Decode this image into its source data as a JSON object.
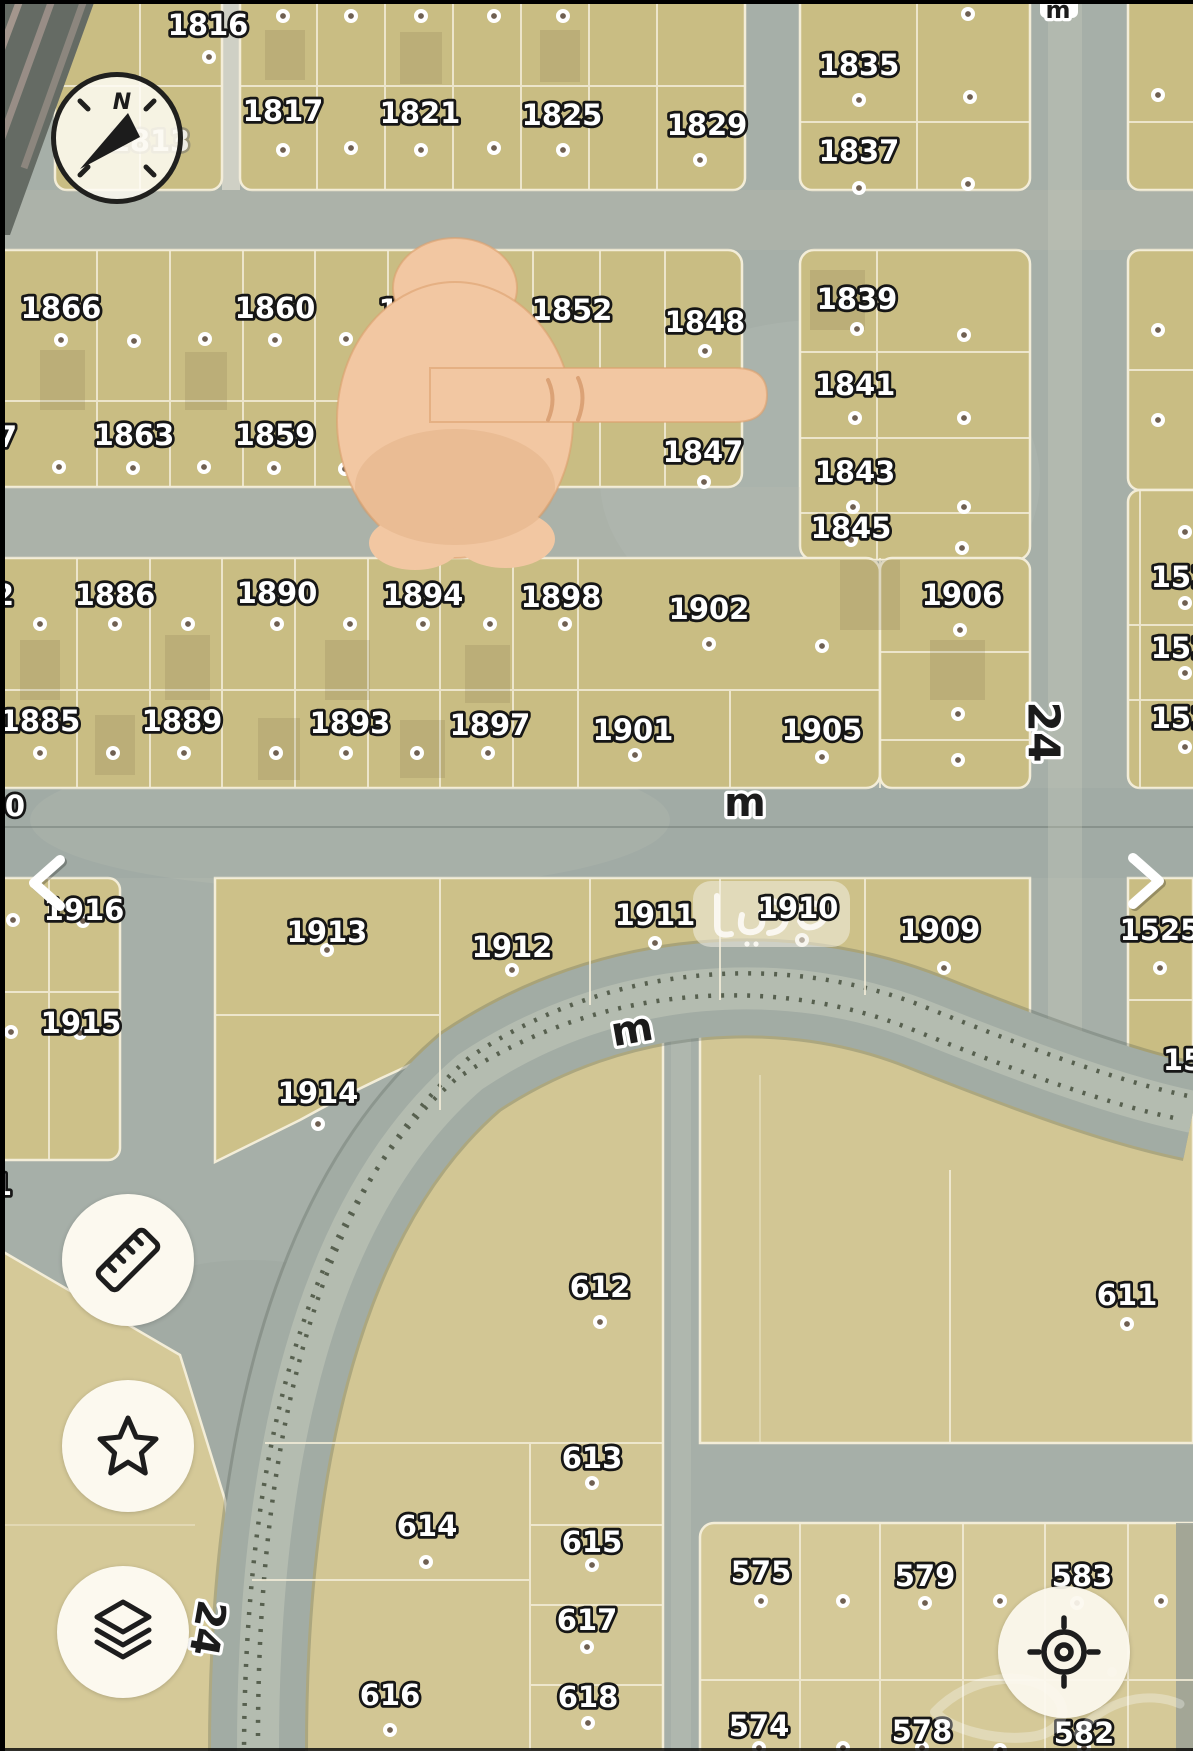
{
  "app": {
    "type": "satellite-parcel-map"
  },
  "colors": {
    "parcel_fill": "#c9bd83",
    "parcel_fill_light": "#d5c998",
    "road": "#a6afa8",
    "block_line": "#f3edd8",
    "label_fill": "#ffffff",
    "label_stroke": "#161616",
    "road_label_fill": "#1b1b1b",
    "dot_inner": "#6f6052",
    "hand_skin": "#f2c7a2",
    "button_bg": "#fcf9ef",
    "icon_stroke": "#1d1d1d"
  },
  "map": {
    "parcel_labels": [
      {
        "t": "1816",
        "x": 208,
        "y": 25
      },
      {
        "t": "1817",
        "x": 283,
        "y": 111
      },
      {
        "t": "1821",
        "x": 420,
        "y": 113
      },
      {
        "t": "1825",
        "x": 562,
        "y": 115
      },
      {
        "t": "1829",
        "x": 707,
        "y": 125
      },
      {
        "t": "1835",
        "x": 859,
        "y": 65
      },
      {
        "t": "1837",
        "x": 859,
        "y": 151
      },
      {
        "t": "1866",
        "x": 61,
        "y": 308
      },
      {
        "t": "1860",
        "x": 275,
        "y": 308
      },
      {
        "t": "1856",
        "x": 419,
        "y": 310
      },
      {
        "t": "1852",
        "x": 572,
        "y": 310
      },
      {
        "t": "1848",
        "x": 705,
        "y": 322
      },
      {
        "t": "7",
        "x": 7,
        "y": 437
      },
      {
        "t": "1863",
        "x": 134,
        "y": 435
      },
      {
        "t": "1859",
        "x": 275,
        "y": 435
      },
      {
        "t": "1847",
        "x": 703,
        "y": 452
      },
      {
        "t": "1839",
        "x": 857,
        "y": 299
      },
      {
        "t": "1841",
        "x": 855,
        "y": 385
      },
      {
        "t": "1843",
        "x": 855,
        "y": 472
      },
      {
        "t": "1845",
        "x": 851,
        "y": 528
      },
      {
        "t": "2",
        "x": 4,
        "y": 595
      },
      {
        "t": "1886",
        "x": 115,
        "y": 595
      },
      {
        "t": "1890",
        "x": 277,
        "y": 593
      },
      {
        "t": "1894",
        "x": 423,
        "y": 595
      },
      {
        "t": "1898",
        "x": 561,
        "y": 597
      },
      {
        "t": "1902",
        "x": 709,
        "y": 609
      },
      {
        "t": "1906",
        "x": 962,
        "y": 595
      },
      {
        "t": "1885",
        "x": 40,
        "y": 721
      },
      {
        "t": "1889",
        "x": 182,
        "y": 721
      },
      {
        "t": "1893",
        "x": 350,
        "y": 723
      },
      {
        "t": "1897",
        "x": 490,
        "y": 725
      },
      {
        "t": "1901",
        "x": 633,
        "y": 730
      },
      {
        "t": "1905",
        "x": 822,
        "y": 730
      },
      {
        "t": "0",
        "x": 15,
        "y": 806
      },
      {
        "t": "152",
        "x": 1181,
        "y": 577
      },
      {
        "t": "152",
        "x": 1181,
        "y": 648
      },
      {
        "t": "152",
        "x": 1181,
        "y": 718
      },
      {
        "t": "1916",
        "x": 84,
        "y": 910
      },
      {
        "t": "1915",
        "x": 81,
        "y": 1023
      },
      {
        "t": "1913",
        "x": 327,
        "y": 932
      },
      {
        "t": "1912",
        "x": 512,
        "y": 947
      },
      {
        "t": "1911",
        "x": 655,
        "y": 915
      },
      {
        "t": "1910",
        "x": 798,
        "y": 908
      },
      {
        "t": "1909",
        "x": 940,
        "y": 930
      },
      {
        "t": "1525",
        "x": 1160,
        "y": 930
      },
      {
        "t": "15",
        "x": 1183,
        "y": 1060
      },
      {
        "t": "1914",
        "x": 318,
        "y": 1093
      },
      {
        "t": "1",
        "x": 2,
        "y": 1185
      },
      {
        "t": "612",
        "x": 600,
        "y": 1287
      },
      {
        "t": "611",
        "x": 1127,
        "y": 1295
      },
      {
        "t": "613",
        "x": 592,
        "y": 1458
      },
      {
        "t": "614",
        "x": 427,
        "y": 1526
      },
      {
        "t": "615",
        "x": 592,
        "y": 1542
      },
      {
        "t": "617",
        "x": 587,
        "y": 1620
      },
      {
        "t": "616",
        "x": 390,
        "y": 1695
      },
      {
        "t": "618",
        "x": 588,
        "y": 1697
      },
      {
        "t": "575",
        "x": 761,
        "y": 1572
      },
      {
        "t": "579",
        "x": 925,
        "y": 1576
      },
      {
        "t": "583",
        "x": 1082,
        "y": 1576
      },
      {
        "t": "574",
        "x": 759,
        "y": 1726
      },
      {
        "t": "578",
        "x": 922,
        "y": 1731
      },
      {
        "t": "582",
        "x": 1084,
        "y": 1733
      }
    ],
    "faded_labels": [
      {
        "t": "1813",
        "x": 150,
        "y": 141
      }
    ],
    "road_labels": [
      {
        "t": "m",
        "x": 745,
        "y": 803,
        "r": 0,
        "s": 40
      },
      {
        "t": "m",
        "x": 632,
        "y": 1030,
        "r": -10,
        "s": 40
      },
      {
        "t": "m",
        "x": 1058,
        "y": 10,
        "r": 0,
        "s": 24
      },
      {
        "t": "24",
        "x": 1043,
        "y": 732,
        "r": 90,
        "s": 44
      },
      {
        "t": "24",
        "x": 207,
        "y": 1628,
        "r": 100,
        "s": 40
      }
    ],
    "dots": [
      [
        209,
        57
      ],
      [
        283,
        16
      ],
      [
        351,
        16
      ],
      [
        421,
        16
      ],
      [
        494,
        16
      ],
      [
        563,
        16
      ],
      [
        283,
        150
      ],
      [
        351,
        148
      ],
      [
        421,
        150
      ],
      [
        494,
        148
      ],
      [
        563,
        150
      ],
      [
        700,
        160
      ],
      [
        859,
        100
      ],
      [
        968,
        14
      ],
      [
        970,
        97
      ],
      [
        859,
        188
      ],
      [
        968,
        184
      ],
      [
        1158,
        95
      ],
      [
        61,
        340
      ],
      [
        134,
        341
      ],
      [
        205,
        339
      ],
      [
        275,
        340
      ],
      [
        346,
        339
      ],
      [
        417,
        340
      ],
      [
        488,
        341
      ],
      [
        705,
        351
      ],
      [
        59,
        467
      ],
      [
        133,
        468
      ],
      [
        204,
        467
      ],
      [
        274,
        468
      ],
      [
        345,
        469
      ],
      [
        704,
        482
      ],
      [
        857,
        329
      ],
      [
        964,
        335
      ],
      [
        855,
        418
      ],
      [
        964,
        418
      ],
      [
        853,
        507
      ],
      [
        964,
        507
      ],
      [
        851,
        540
      ],
      [
        962,
        548
      ],
      [
        1158,
        330
      ],
      [
        1158,
        420
      ],
      [
        40,
        624
      ],
      [
        115,
        624
      ],
      [
        188,
        624
      ],
      [
        277,
        624
      ],
      [
        350,
        624
      ],
      [
        423,
        624
      ],
      [
        490,
        624
      ],
      [
        565,
        624
      ],
      [
        709,
        644
      ],
      [
        822,
        646
      ],
      [
        960,
        630
      ],
      [
        40,
        753
      ],
      [
        113,
        753
      ],
      [
        184,
        753
      ],
      [
        276,
        753
      ],
      [
        346,
        753
      ],
      [
        417,
        753
      ],
      [
        488,
        753
      ],
      [
        635,
        755
      ],
      [
        822,
        757
      ],
      [
        958,
        714
      ],
      [
        958,
        760
      ],
      [
        1185,
        532
      ],
      [
        1185,
        603
      ],
      [
        1185,
        673
      ],
      [
        1185,
        747
      ],
      [
        13,
        920
      ],
      [
        83,
        921
      ],
      [
        11,
        1032
      ],
      [
        80,
        1033
      ],
      [
        327,
        950
      ],
      [
        512,
        970
      ],
      [
        655,
        943
      ],
      [
        802,
        940
      ],
      [
        944,
        968
      ],
      [
        318,
        1124
      ],
      [
        1160,
        968
      ],
      [
        600,
        1322
      ],
      [
        1127,
        1324
      ],
      [
        592,
        1483
      ],
      [
        592,
        1565
      ],
      [
        587,
        1647
      ],
      [
        588,
        1723
      ],
      [
        426,
        1562
      ],
      [
        390,
        1730
      ],
      [
        761,
        1601
      ],
      [
        843,
        1601
      ],
      [
        925,
        1603
      ],
      [
        1000,
        1601
      ],
      [
        1077,
        1603
      ],
      [
        1161,
        1601
      ],
      [
        759,
        1748
      ],
      [
        843,
        1748
      ],
      [
        922,
        1748
      ],
      [
        1000,
        1750
      ],
      [
        1084,
        1748
      ]
    ]
  },
  "watermark": {
    "text": "عديل"
  },
  "controls": {
    "compass": {
      "letter": "N"
    },
    "chevrons": {
      "left": "‹",
      "right": "›"
    },
    "buttons": [
      {
        "id": "measure",
        "icon": "ruler-icon"
      },
      {
        "id": "favorites",
        "icon": "star-icon"
      },
      {
        "id": "layers",
        "icon": "layers-icon"
      },
      {
        "id": "locate",
        "icon": "crosshair-icon"
      }
    ]
  }
}
